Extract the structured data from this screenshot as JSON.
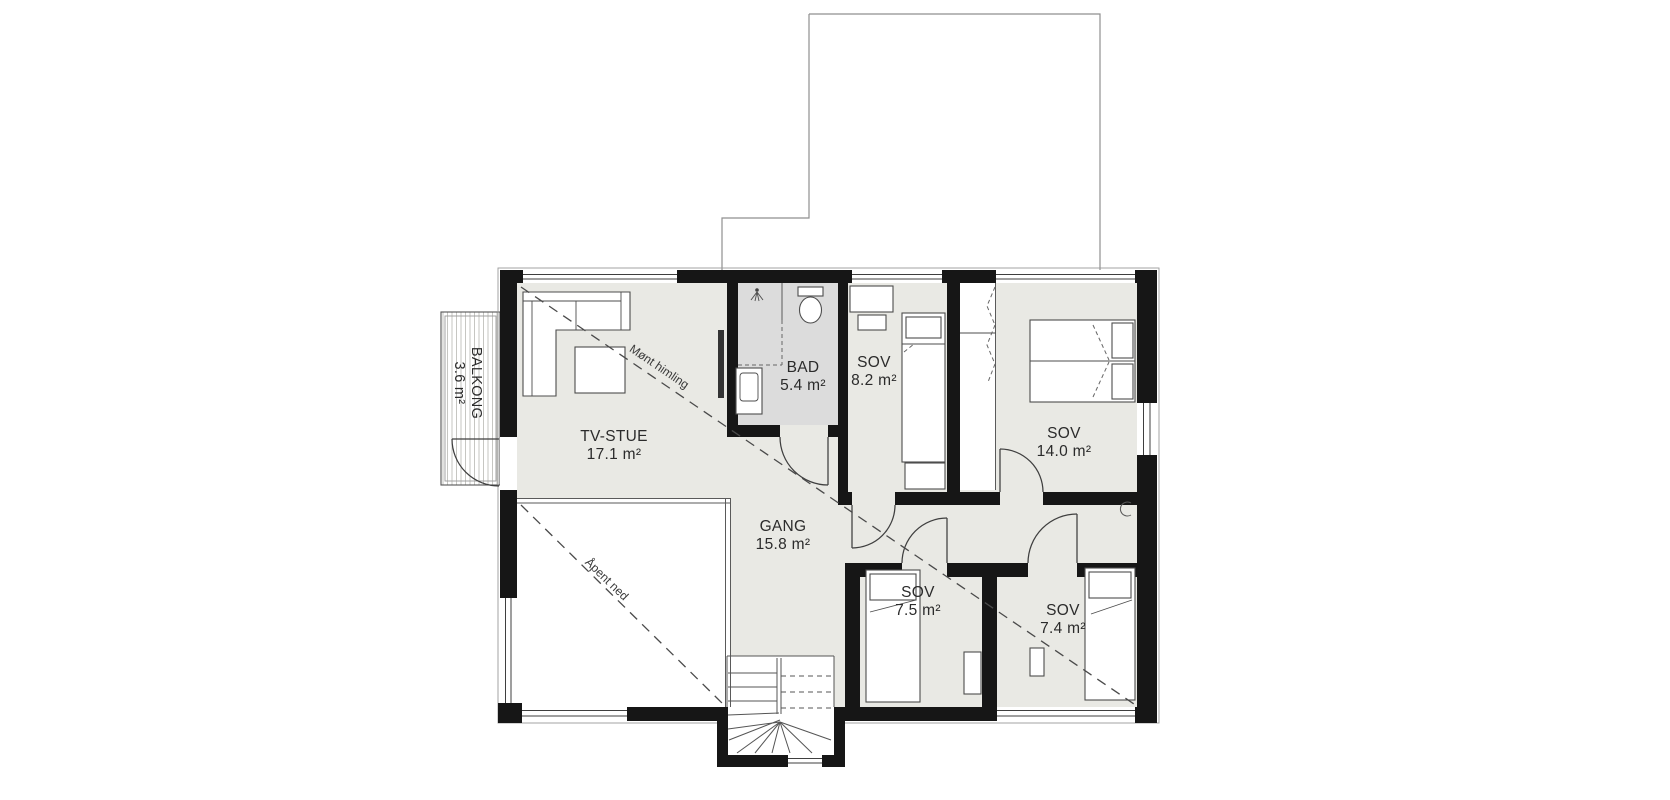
{
  "drawing": {
    "kind": "floor-plan",
    "colors": {
      "floor": "#e9e9e4",
      "bathroom_floor": "#dcdcdc",
      "wall": "#161616",
      "line": "#4d4d4d",
      "roof_line": "#8f8f8f",
      "hatch": "#c6c6c2",
      "text": "#2b2b2b"
    },
    "rooms": [
      {
        "name": "BALKONG",
        "area": "3.6 m²"
      },
      {
        "name": "TV-STUE",
        "area": "17.1 m²"
      },
      {
        "name": "BAD",
        "area": "5.4 m²"
      },
      {
        "name": "SOV",
        "area": "8.2 m²"
      },
      {
        "name": "SOV",
        "area": "14.0 m²"
      },
      {
        "name": "GANG",
        "area": "15.8 m²"
      },
      {
        "name": "SOV",
        "area": "7.5 m²"
      },
      {
        "name": "SOV",
        "area": "7.4 m²"
      }
    ],
    "annotations": [
      {
        "text": "Mønt himling"
      },
      {
        "text": "Åpent ned"
      }
    ]
  }
}
